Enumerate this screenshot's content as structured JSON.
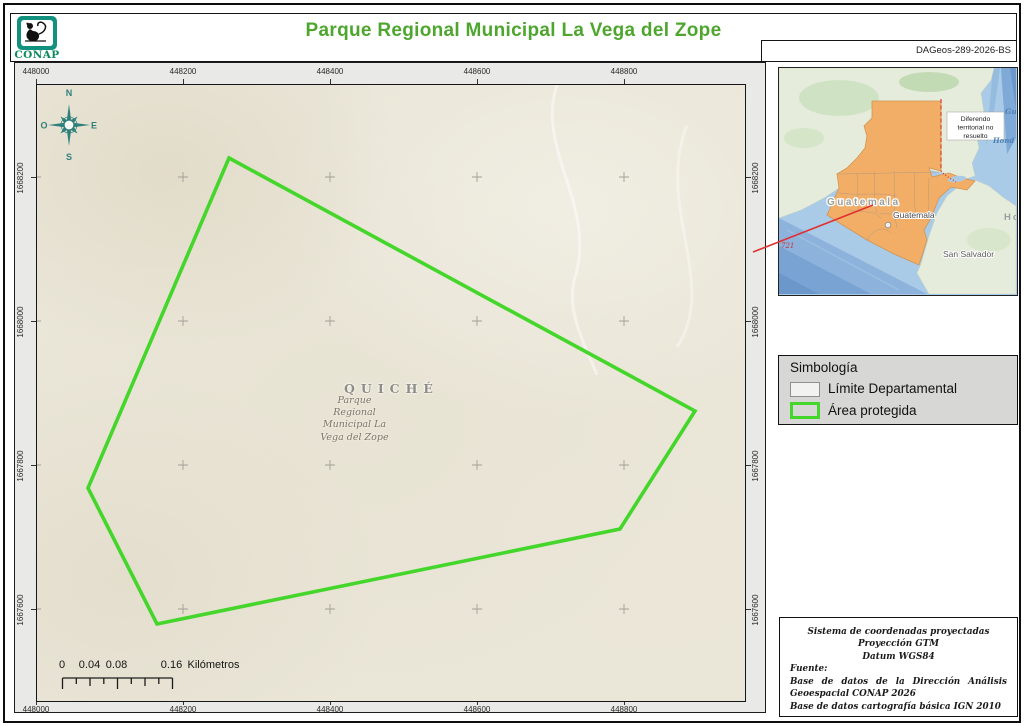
{
  "header": {
    "title": "Parque Regional Municipal La Vega del Zope",
    "logo_text": "CONAP",
    "code": "DAGeos-289-2026-BS"
  },
  "map": {
    "x_labels": [
      "448000",
      "448200",
      "448400",
      "448600",
      "448800"
    ],
    "y_labels": [
      "1668200",
      "1668000",
      "1667800",
      "1667600"
    ],
    "region_label": "QUICHÉ",
    "area_label_lines": [
      "Parque",
      "Regional",
      "Municipal La",
      "Vega del Zope"
    ],
    "compass": {
      "n": "N",
      "e": "E",
      "s": "S",
      "o": "O"
    },
    "scalebar": {
      "labels": [
        "0",
        "0.04",
        "0.08",
        "0.16"
      ],
      "unit": "Kilómetros"
    }
  },
  "inset": {
    "country_label": "Guatemala",
    "city_label": "Guatemala",
    "city2_label": "San Salvador",
    "honduras_fragment": "Ho",
    "water_fragment_1": "Gu",
    "water_fragment_2": "Hond",
    "road_label": "721",
    "dispute_note_lines": [
      "Diferendo",
      "territorial no",
      "resuelto"
    ]
  },
  "legend": {
    "title": "Simbología",
    "items": [
      {
        "label": "Límite Departamental",
        "swatch": "department-boundary"
      },
      {
        "label": "Área protegida",
        "swatch": "protected-area"
      }
    ]
  },
  "metadata": {
    "crs_lines": [
      "Sistema de coordenadas proyectadas",
      "Proyección GTM",
      "Datum WGS84"
    ],
    "source_label": "Fuente:",
    "source_1": "Base de datos de la Dirección Análisis Geoespacial CONAP 2026",
    "source_2": "Base de datos cartografía básica IGN 2010"
  },
  "colors": {
    "title_green": "#4ea62f",
    "protected_area_green": "#44d62a",
    "logo_teal": "#12917e",
    "guatemala_orange": "#f2ae66",
    "dispute_line_red": "#d93025",
    "leader_line_red": "#e03131",
    "compass_teal": "#2f807c"
  }
}
